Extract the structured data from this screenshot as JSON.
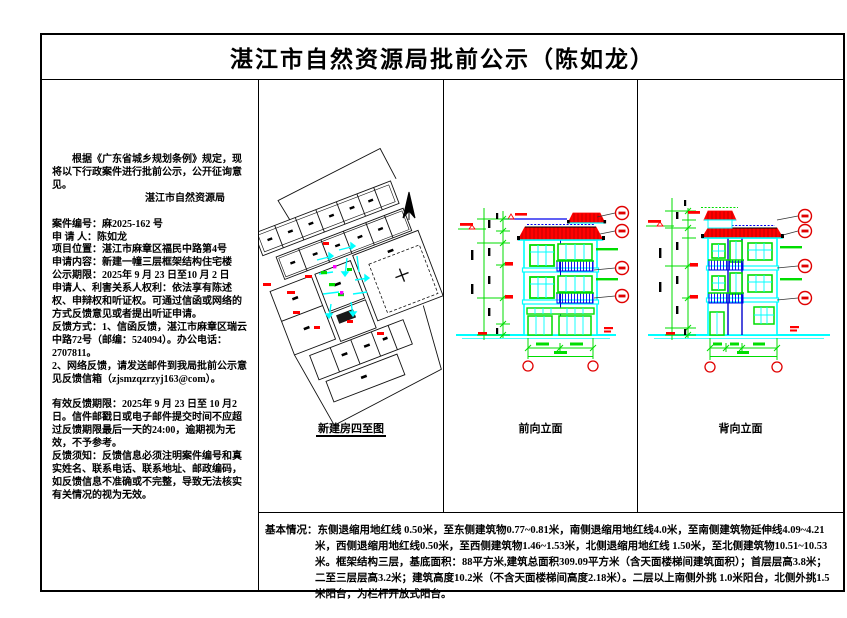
{
  "page": {
    "title": "湛江市自然资源局批前公示（陈如龙）"
  },
  "left_panel": {
    "intro": "根据《广东省城乡规划条例》规定，现将以下行政案件进行批前公示，公开征询意见。",
    "agency": "湛江市自然资源局",
    "details": [
      "案件编号：麻2025-162 号",
      "申 请 人：陈如龙",
      "项目位置：湛江市麻章区福民中路第4号",
      "申请内容：新建一幢三层框架结构住宅楼",
      "公示期限：2025年 9 月 23 日至10 月 2 日",
      "申请人、利害关系人权利：依法享有陈述权、申辩权和听证权。可通过信函或网络的方式反馈意见或者提出听证申请。",
      "反馈方式：1、信函反馈，湛江市麻章区瑞云中路72号（邮编：524094）。办公电话：2707811。",
      "2、网络反馈，请发送邮件到我局批前公示意见反馈信箱（zjsmzqzrzyj163@com）。"
    ],
    "feedback_deadline": "有效反馈期限：2025年 9 月 23 日至 10 月2日。信件邮戳日或电子邮件提交时间不应超过反馈期限最后一天的24:00，逾期视为无效，不予参考。",
    "feedback_notice": "反馈须知：反馈信息必须注明案件编号和真实姓名、联系电话、联系地址、邮政编码，如反馈信息不准确或不完整，导致无法核实有关情况的视为无效。"
  },
  "drawings": {
    "site_plan_label": "新建房四至图",
    "front_elevation_label": "前向立面",
    "rear_elevation_label": "背向立面"
  },
  "basic_info": {
    "label": "基本情况：",
    "text": "东侧退缩用地红线 0.50米，至东侧建筑物0.77~0.81米，南侧退缩用地红线4.0米，至南侧建筑物延伸线4.09~4.21米，西侧退缩用地红线0.50米，至西侧建筑物1.46~1.53米，北侧退缩用地红线 1.50米，至北侧建筑物10.51~10.53米。框架结构三层，基底面积：88平方米,建筑总面积309.09平方米（含天面楼梯间建筑面积）；首层层高3.8米；二至三层层高3.2米；建筑高度10.2米（不含天面楼梯间高度2.18米）。二层以上南侧外挑 1.0米阳台，北侧外挑1.5米阳台，为栏杆开放式阳台。"
  },
  "cad_palette": {
    "outline_cyan": "#00ffff",
    "frame_green": "#00dd00",
    "roof_red": "#ff0000",
    "rail_blue": "#0000ee",
    "marker_magenta": "#ff00ff",
    "line_black": "#000000"
  }
}
